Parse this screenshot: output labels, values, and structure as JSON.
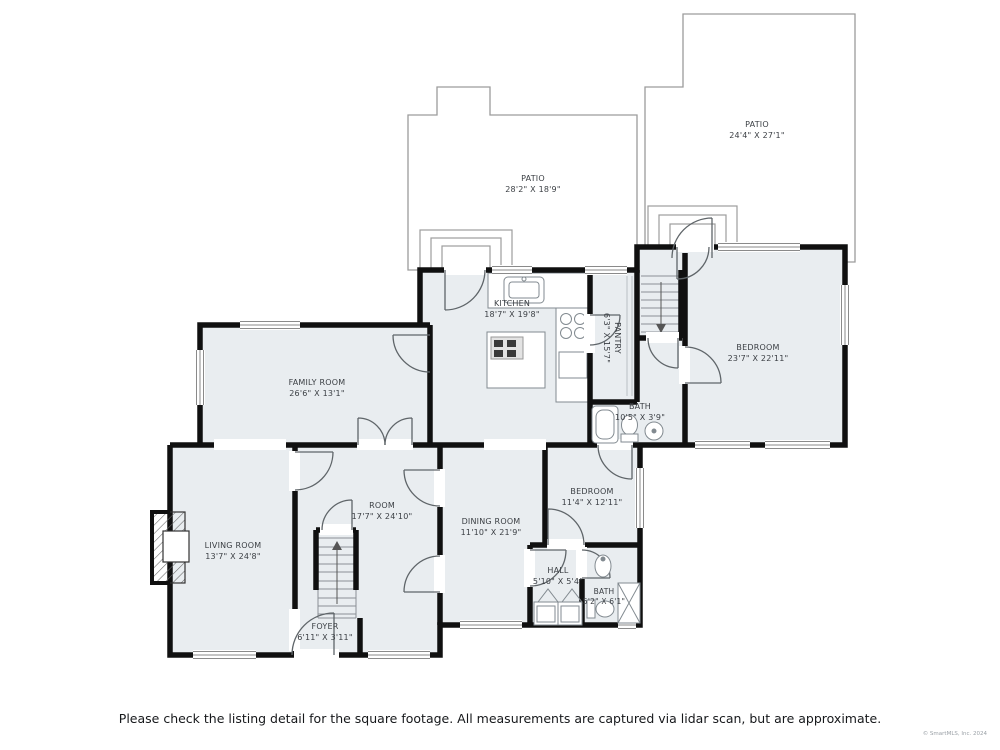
{
  "rooms": [
    {
      "id": "patio-right",
      "name": "PATIO",
      "dims": "24'4\" X 27'1\""
    },
    {
      "id": "patio-mid",
      "name": "PATIO",
      "dims": "28'2\" X 18'9\""
    },
    {
      "id": "kitchen",
      "name": "KITCHEN",
      "dims": "18'7\" X 19'8\""
    },
    {
      "id": "pantry",
      "name": "PANTRY",
      "dims": "6'3\" X 15'7\""
    },
    {
      "id": "bedroom-main",
      "name": "BEDROOM",
      "dims": "23'7\" X 22'11\""
    },
    {
      "id": "family-room",
      "name": "FAMILY ROOM",
      "dims": "26'6\" X 13'1\""
    },
    {
      "id": "bath-upper",
      "name": "BATH",
      "dims": "10'5\" X 3'9\""
    },
    {
      "id": "bedroom-second",
      "name": "BEDROOM",
      "dims": "11'4\" X 12'11\""
    },
    {
      "id": "room",
      "name": "ROOM",
      "dims": "17'7\" X 24'10\""
    },
    {
      "id": "dining-room",
      "name": "DINING ROOM",
      "dims": "11'10\" X 21'9\""
    },
    {
      "id": "living-room",
      "name": "LIVING ROOM",
      "dims": "13'7\" X 24'8\""
    },
    {
      "id": "hall",
      "name": "HALL",
      "dims": "5'10\" X 5'4\""
    },
    {
      "id": "bath-lower",
      "name": "BATH",
      "dims": "5'2\" X 6'1\""
    },
    {
      "id": "foyer",
      "name": "FOYER",
      "dims": "6'11\" X 3'11\""
    }
  ],
  "footer": {
    "disclaimer": "Please check the listing detail for the square footage. All measurements are captured via lidar scan, but are approximate.",
    "copyright": "© SmartMLS, Inc. 2024"
  },
  "colors": {
    "wall": "#101010",
    "room_fill": "#e9edf0",
    "detail_line": "#808080",
    "patio_outline": "#9c9c9c"
  }
}
